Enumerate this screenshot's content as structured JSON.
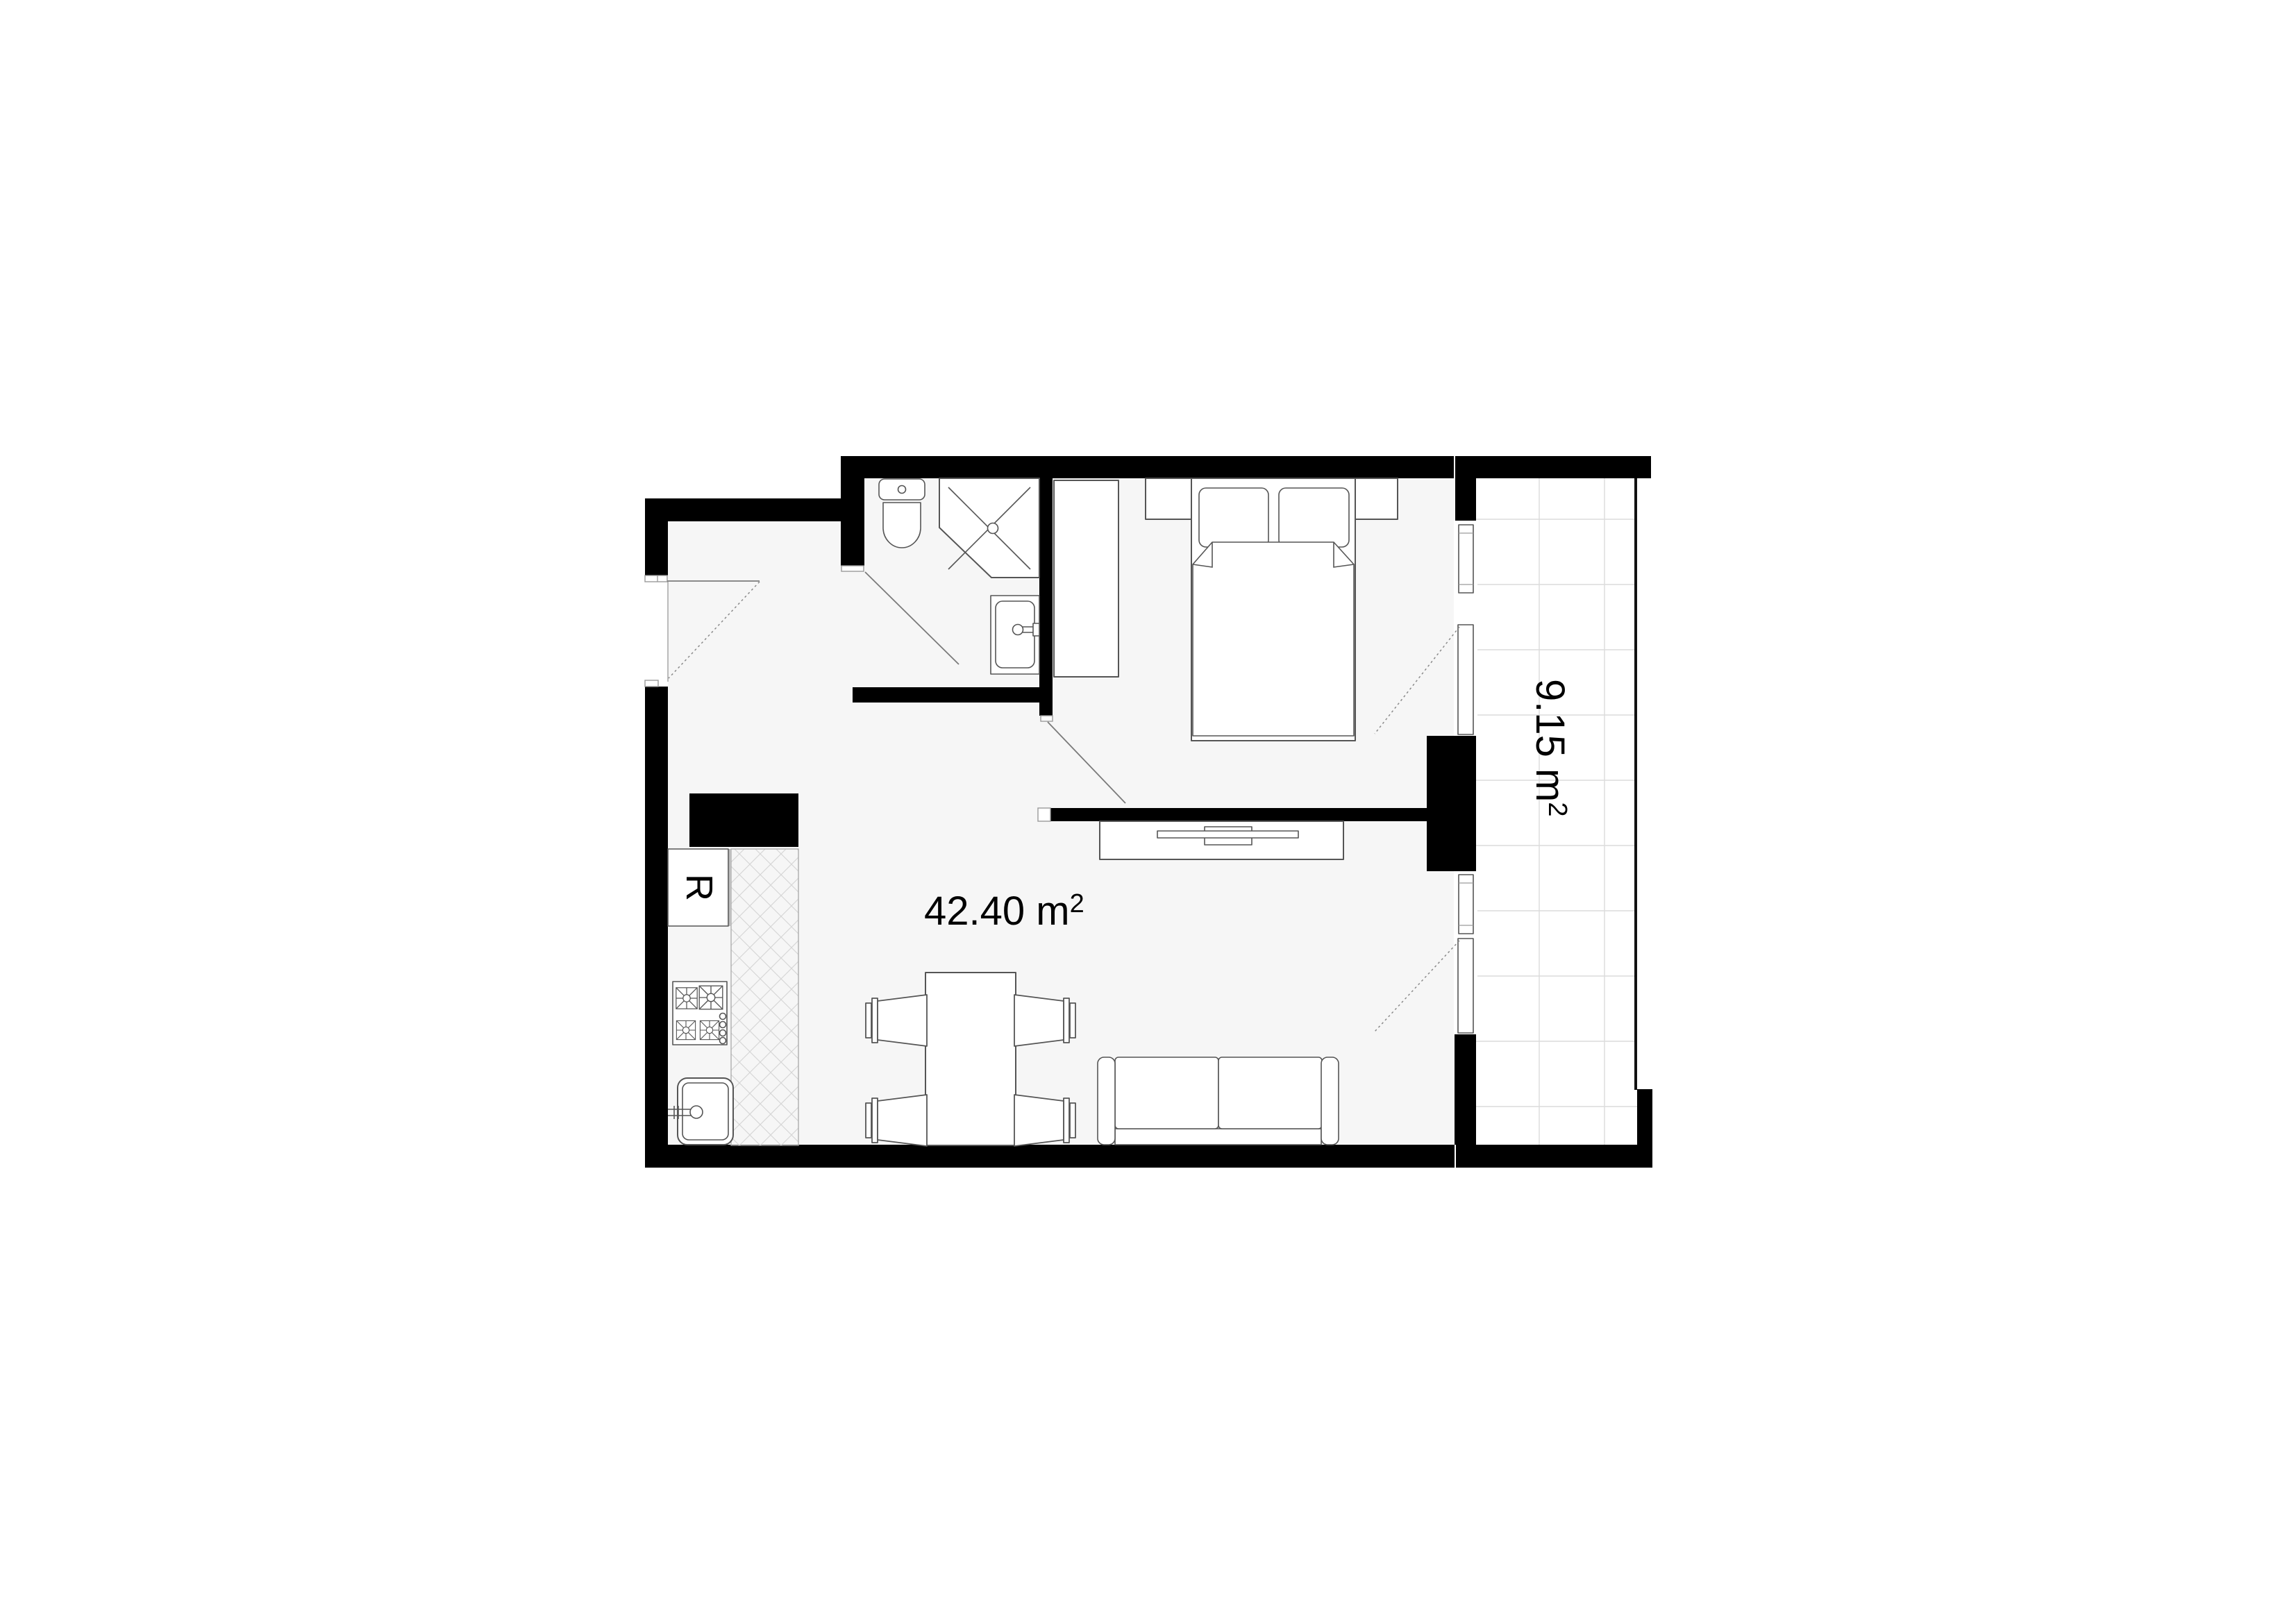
{
  "meta": {
    "title": "Apartment floor plan",
    "kind": "architectural-floor-plan"
  },
  "colors": {
    "background": "#ffffff",
    "wall": "#000000",
    "floor": "#f6f6f6",
    "balcony_floor": "#ffffff",
    "fixture_line": "#555555",
    "door_swing_line": "#8a8a8a",
    "tile_line": "#dcdcdc",
    "hatch_line": "#d6d6d6",
    "text": "#000000"
  },
  "labels": {
    "living_room_area": {
      "text": "42.40 m²",
      "base": "42.40 m",
      "sup": "2"
    },
    "balcony_area": {
      "text": "9.15 m²",
      "base": "9.15 m",
      "sup": "2"
    },
    "refrigerator": {
      "text": "R"
    }
  },
  "rooms": [
    {
      "name": "living-room-with-kitchen",
      "area_m2": "42.40"
    },
    {
      "name": "bedroom"
    },
    {
      "name": "bathroom"
    },
    {
      "name": "entry-hall"
    },
    {
      "name": "balcony",
      "area_m2": "9.15"
    }
  ],
  "fixtures": [
    "toilet",
    "corner-shower",
    "washbasin",
    "wardrobe",
    "double-bed",
    "pillow",
    "pillow",
    "nightstand",
    "nightstand",
    "tv-sideboard",
    "tv",
    "dining-table",
    "chair",
    "chair",
    "chair",
    "chair",
    "sofa",
    "refrigerator",
    "cooktop",
    "kitchen-sink",
    "countertop",
    "entry-door",
    "bathroom-door",
    "bedroom-door",
    "balcony-door",
    "balcony-door",
    "window",
    "window",
    "balcony-railing",
    "balcony-tiles"
  ]
}
